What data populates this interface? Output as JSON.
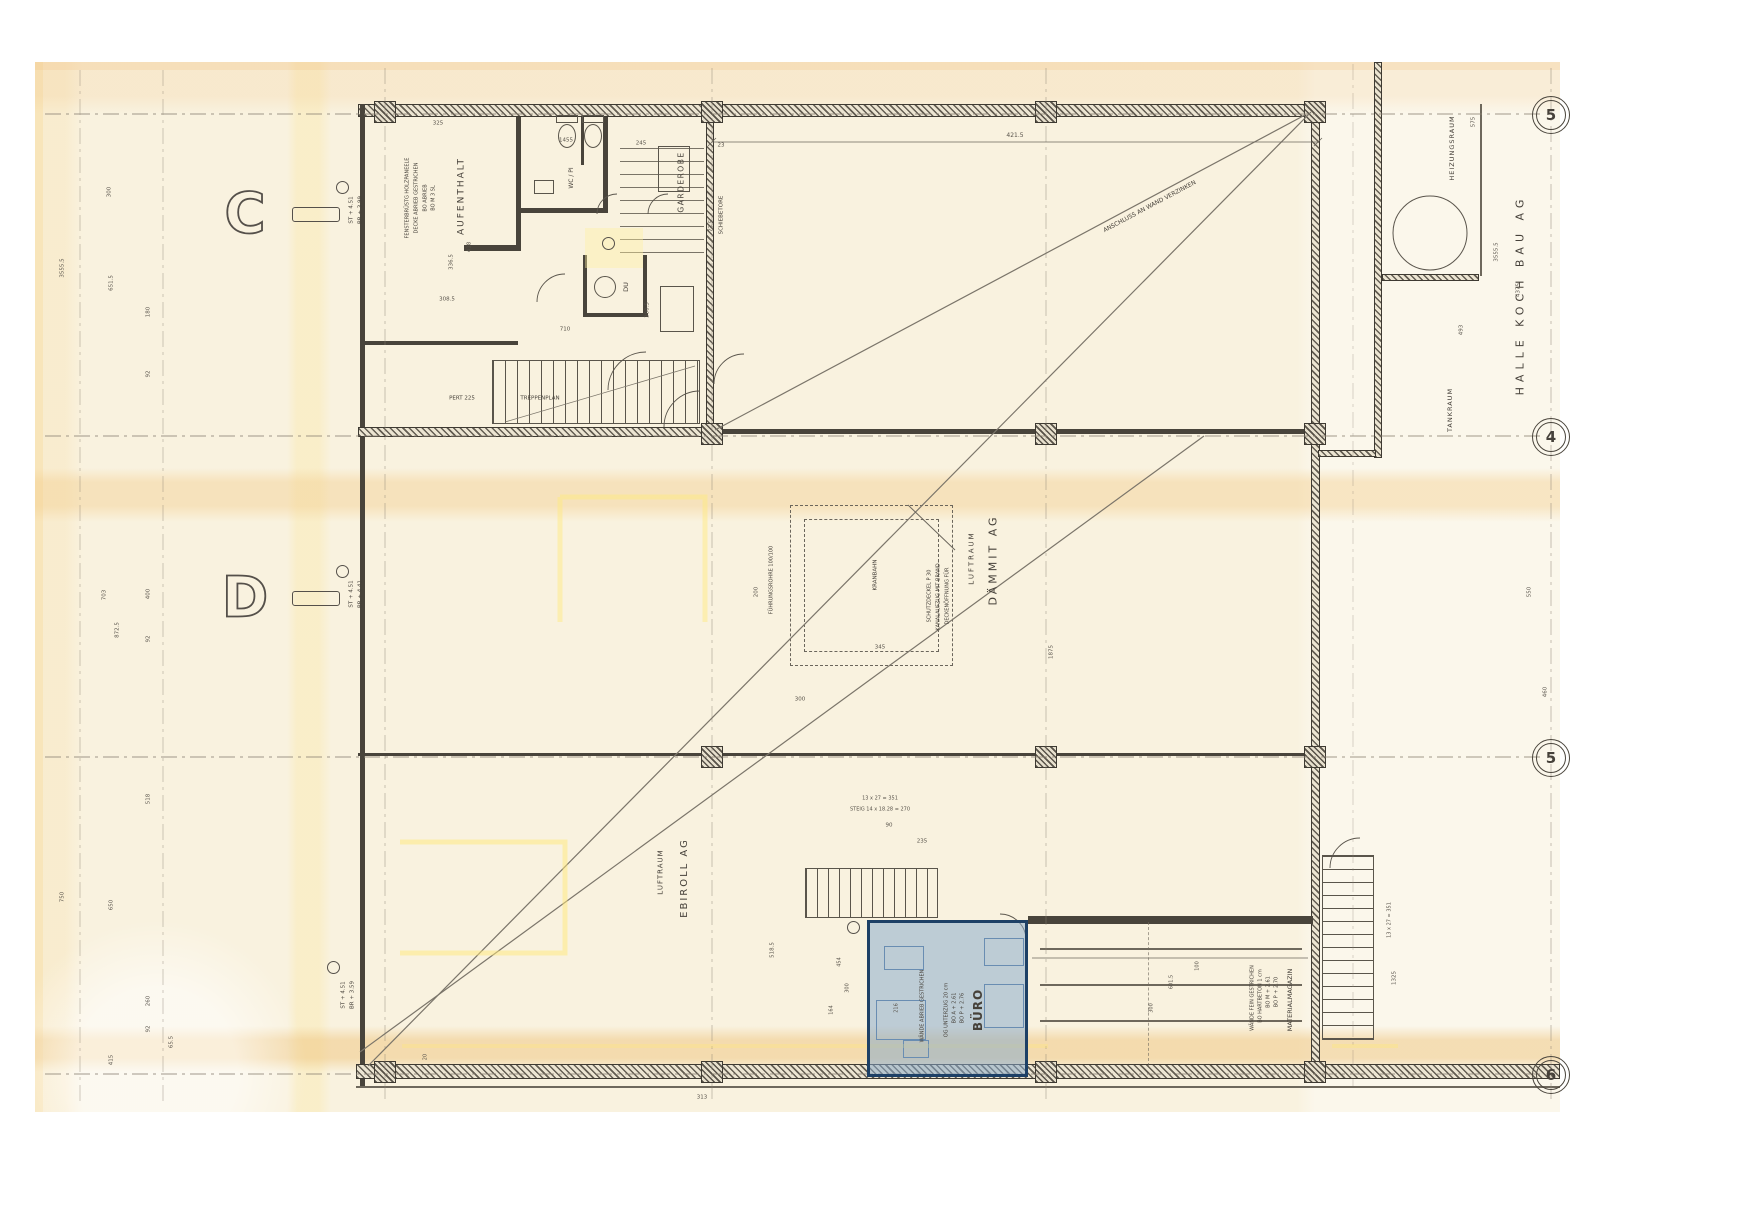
{
  "plan": {
    "colors": {
      "paper": "#f9f2df",
      "ink": "#46413a",
      "dim_text": "#57524a",
      "highlight_fill": "#87a9cc",
      "highlight_border": "#1d4066",
      "highlighter_yellow": "#ffe87a"
    },
    "highlight": {
      "room": "BÜRO"
    },
    "axis_markers": [
      {
        "label": "5",
        "x": 1550,
        "y": 114
      },
      {
        "label": "4",
        "x": 1550,
        "y": 436
      },
      {
        "label": "5",
        "x": 1550,
        "y": 757
      },
      {
        "label": "6",
        "x": 1550,
        "y": 1074
      }
    ],
    "section_letters": [
      {
        "letter": "C",
        "x": 245,
        "y": 214,
        "bar_x": 292,
        "bar_y": 207
      },
      {
        "letter": "D",
        "x": 245,
        "y": 598,
        "bar_x": 292,
        "bar_y": 591
      }
    ],
    "rings": [
      {
        "x": 341,
        "y": 186
      },
      {
        "x": 341,
        "y": 570
      },
      {
        "x": 332,
        "y": 966
      },
      {
        "x": 607,
        "y": 242
      },
      {
        "x": 852,
        "y": 926
      }
    ],
    "labels": [
      {
        "t": "AUFENTHALT",
        "x": 462,
        "y": 196,
        "r": -90,
        "s": 9,
        "sp": 2
      },
      {
        "t": "BO M 3 SL",
        "x": 434,
        "y": 198,
        "r": -90,
        "s": 5
      },
      {
        "t": "BO ABRIEB",
        "x": 426,
        "y": 198,
        "r": -90,
        "s": 5
      },
      {
        "t": "DECKE ABRIEB GESTRICHEN",
        "x": 417,
        "y": 198,
        "r": -90,
        "s": 5
      },
      {
        "t": "FENSTERBRÜSTG HOLZPANEELE",
        "x": 408,
        "y": 198,
        "r": -90,
        "s": 5
      },
      {
        "t": "GARDEROBE",
        "x": 681,
        "y": 182,
        "r": -90,
        "s": 7.5,
        "sp": 1.5
      },
      {
        "t": "WC / PI",
        "x": 572,
        "y": 178,
        "r": -90,
        "s": 6
      },
      {
        "t": "DU",
        "x": 626,
        "y": 287,
        "r": -90,
        "s": 6.5
      },
      {
        "t": "SCHIEBETORE",
        "x": 722,
        "y": 215,
        "r": -90,
        "s": 5.5
      },
      {
        "t": "TREPPENPLAN",
        "x": 540,
        "y": 399,
        "s": 5.5
      },
      {
        "t": "PERT 225",
        "x": 462,
        "y": 399,
        "s": 5.5
      },
      {
        "t": "DÄMMIT AG",
        "x": 993,
        "y": 560,
        "r": -90,
        "s": 11,
        "sp": 3
      },
      {
        "t": "LUFTRAUM",
        "x": 972,
        "y": 558,
        "r": -90,
        "s": 7,
        "sp": 2
      },
      {
        "t": "KRANBAHN",
        "x": 876,
        "y": 575,
        "r": -90,
        "s": 5.5
      },
      {
        "t": "DECKENÖFFNUNG FÜR",
        "x": 948,
        "y": 596,
        "r": -90,
        "s": 5
      },
      {
        "t": "KANALAUFZUG MIT BRAND-",
        "x": 939,
        "y": 596,
        "r": -90,
        "s": 5
      },
      {
        "t": "SCHUTZDECKEL P 30",
        "x": 930,
        "y": 596,
        "r": -90,
        "s": 5
      },
      {
        "t": "FÜHRUNGSROHRE 100/100",
        "x": 772,
        "y": 580,
        "r": -90,
        "s": 5
      },
      {
        "t": "EBIROLL AG",
        "x": 685,
        "y": 878,
        "r": -90,
        "s": 10,
        "sp": 2
      },
      {
        "t": "LUFTRAUM",
        "x": 661,
        "y": 872,
        "r": -90,
        "s": 7,
        "sp": 1
      },
      {
        "t": "HALLE KOCH BAU AG",
        "x": 1520,
        "y": 295,
        "r": -90,
        "s": 11,
        "sp": 5
      },
      {
        "t": "HEIZUNGSRAUM",
        "x": 1452,
        "y": 148,
        "r": -90,
        "s": 6.5,
        "sp": 1
      },
      {
        "t": "TANKRAUM",
        "x": 1450,
        "y": 410,
        "r": -90,
        "s": 6.5,
        "sp": 1
      },
      {
        "t": "MATERIALMAGAZIN",
        "x": 1290,
        "y": 1000,
        "r": -90,
        "s": 6.5
      },
      {
        "t": "BO P + 2.70",
        "x": 1277,
        "y": 992,
        "r": -90,
        "s": 5
      },
      {
        "t": "BO M + 2.61",
        "x": 1269,
        "y": 992,
        "r": -90,
        "s": 5
      },
      {
        "t": "BO HARTBETON 1 cm",
        "x": 1261,
        "y": 996,
        "r": -90,
        "s": 5
      },
      {
        "t": "WÄNDE FEIN GESTRICHEN",
        "x": 1253,
        "y": 998,
        "r": -90,
        "s": 5
      },
      {
        "t": "BÜRO",
        "x": 978,
        "y": 1010,
        "r": -90,
        "s": 12,
        "w": 700,
        "sp": 1
      },
      {
        "t": "BO P + 2.76",
        "x": 963,
        "y": 1008,
        "r": -90,
        "s": 5
      },
      {
        "t": "BO A + 2.61",
        "x": 955,
        "y": 1008,
        "r": -90,
        "s": 5
      },
      {
        "t": "OG UNTERZUG 20 cm",
        "x": 947,
        "y": 1010,
        "r": -90,
        "s": 5
      },
      {
        "t": "WÄNDE ABRIEB GESTRICHEN",
        "x": 923,
        "y": 1006,
        "r": -90,
        "s": 5
      },
      {
        "t": "ANSCHLUSS AN WAND VERZINKEN",
        "x": 1150,
        "y": 207,
        "r": -28,
        "s": 6
      },
      {
        "t": "ST + 4.51",
        "x": 352,
        "y": 210,
        "r": -90,
        "s": 5.5
      },
      {
        "t": "BR + 3.99",
        "x": 361,
        "y": 210,
        "r": -90,
        "s": 5.5
      },
      {
        "t": "ST + 4.51",
        "x": 352,
        "y": 594,
        "r": -90,
        "s": 5.5
      },
      {
        "t": "BR + 4.41",
        "x": 361,
        "y": 594,
        "r": -90,
        "s": 5.5
      },
      {
        "t": "ST + 4.51",
        "x": 344,
        "y": 995,
        "r": -90,
        "s": 5.5
      },
      {
        "t": "BR + 3.59",
        "x": 353,
        "y": 995,
        "r": -90,
        "s": 5.5
      },
      {
        "t": "421.5",
        "x": 1015,
        "y": 136,
        "s": 6,
        "c": "dim"
      },
      {
        "t": "325",
        "x": 438,
        "y": 124,
        "s": 5.5,
        "c": "dim"
      },
      {
        "t": "1455",
        "x": 566,
        "y": 141,
        "s": 5.5,
        "c": "dim"
      },
      {
        "t": "245",
        "x": 641,
        "y": 144,
        "s": 5.5,
        "c": "dim"
      },
      {
        "t": "23",
        "x": 721,
        "y": 146,
        "s": 5.5,
        "c": "dim"
      },
      {
        "t": "73.5",
        "x": 712,
        "y": 226,
        "r": -90,
        "s": 5.5,
        "c": "dim"
      },
      {
        "t": "418",
        "x": 470,
        "y": 247,
        "r": -90,
        "s": 5.5,
        "c": "dim"
      },
      {
        "t": "336.5",
        "x": 452,
        "y": 262,
        "r": -90,
        "s": 5.5,
        "c": "dim"
      },
      {
        "t": "308.5",
        "x": 447,
        "y": 300,
        "s": 5.5,
        "c": "dim"
      },
      {
        "t": "710",
        "x": 565,
        "y": 330,
        "s": 5.5,
        "c": "dim"
      },
      {
        "t": "300.5",
        "x": 648,
        "y": 310,
        "r": -90,
        "s": 5.5,
        "c": "dim"
      },
      {
        "t": "1875",
        "x": 1052,
        "y": 652,
        "r": -90,
        "s": 5.5,
        "c": "dim"
      },
      {
        "t": "200",
        "x": 757,
        "y": 592,
        "r": -90,
        "s": 5.5,
        "c": "dim"
      },
      {
        "t": "300",
        "x": 800,
        "y": 700,
        "s": 5.5,
        "c": "dim"
      },
      {
        "t": "345",
        "x": 880,
        "y": 648,
        "s": 5.5,
        "c": "dim"
      },
      {
        "t": "90",
        "x": 889,
        "y": 826,
        "s": 5.5,
        "c": "dim"
      },
      {
        "t": "235",
        "x": 922,
        "y": 842,
        "s": 5.5,
        "c": "dim"
      },
      {
        "t": "13 x 27 = 351",
        "x": 880,
        "y": 799,
        "s": 5,
        "c": "dim"
      },
      {
        "t": "STEIG 14 x 18.28 = 270",
        "x": 880,
        "y": 810,
        "s": 5,
        "c": "dim"
      },
      {
        "t": "518.5",
        "x": 773,
        "y": 950,
        "r": -90,
        "s": 5.5,
        "c": "dim"
      },
      {
        "t": "454",
        "x": 840,
        "y": 962,
        "r": -90,
        "s": 5,
        "c": "dim"
      },
      {
        "t": "300",
        "x": 848,
        "y": 988,
        "r": -90,
        "s": 5,
        "c": "dim"
      },
      {
        "t": "164",
        "x": 832,
        "y": 1010,
        "r": -90,
        "s": 5,
        "c": "dim"
      },
      {
        "t": "216",
        "x": 897,
        "y": 1008,
        "r": -90,
        "s": 5,
        "c": "dim"
      },
      {
        "t": "20",
        "x": 426,
        "y": 1057,
        "r": -90,
        "s": 5,
        "c": "dim"
      },
      {
        "t": "313",
        "x": 702,
        "y": 1098,
        "s": 5.5,
        "c": "dim"
      },
      {
        "t": "100",
        "x": 1198,
        "y": 966,
        "r": -90,
        "s": 5,
        "c": "dim"
      },
      {
        "t": "601.5",
        "x": 1172,
        "y": 982,
        "r": -90,
        "s": 5,
        "c": "dim"
      },
      {
        "t": "300",
        "x": 1152,
        "y": 1008,
        "r": -90,
        "s": 5,
        "c": "dim"
      },
      {
        "t": "1325",
        "x": 1395,
        "y": 978,
        "r": -90,
        "s": 5.5,
        "c": "dim"
      },
      {
        "t": "493",
        "x": 1462,
        "y": 330,
        "r": -90,
        "s": 5.5,
        "c": "dim"
      },
      {
        "t": "575",
        "x": 1474,
        "y": 122,
        "r": -90,
        "s": 5.5,
        "c": "dim"
      },
      {
        "t": "3555.5",
        "x": 1497,
        "y": 252,
        "r": -90,
        "s": 5.5,
        "c": "dim"
      },
      {
        "t": "4375",
        "x": 1519,
        "y": 290,
        "r": -90,
        "s": 5.5,
        "c": "dim"
      },
      {
        "t": "550",
        "x": 1530,
        "y": 592,
        "r": -90,
        "s": 5.5,
        "c": "dim"
      },
      {
        "t": "460",
        "x": 1546,
        "y": 692,
        "r": -90,
        "s": 5.5,
        "c": "dim"
      },
      {
        "t": "13 x 27 = 351",
        "x": 1390,
        "y": 920,
        "r": -90,
        "s": 5,
        "c": "dim"
      },
      {
        "t": "300",
        "x": 110,
        "y": 192,
        "r": -90,
        "s": 5.5,
        "c": "dim"
      },
      {
        "t": "3555.5",
        "x": 63,
        "y": 268,
        "r": -90,
        "s": 5.5,
        "c": "dim"
      },
      {
        "t": "651.5",
        "x": 112,
        "y": 283,
        "r": -90,
        "s": 5.5,
        "c": "dim"
      },
      {
        "t": "180",
        "x": 149,
        "y": 312,
        "r": -90,
        "s": 5.5,
        "c": "dim"
      },
      {
        "t": "92",
        "x": 149,
        "y": 374,
        "r": -90,
        "s": 5.5,
        "c": "dim"
      },
      {
        "t": "703",
        "x": 105,
        "y": 595,
        "r": -90,
        "s": 5.5,
        "c": "dim"
      },
      {
        "t": "872.5",
        "x": 118,
        "y": 630,
        "r": -90,
        "s": 5.5,
        "c": "dim"
      },
      {
        "t": "400",
        "x": 149,
        "y": 594,
        "r": -90,
        "s": 5.5,
        "c": "dim"
      },
      {
        "t": "92",
        "x": 149,
        "y": 639,
        "r": -90,
        "s": 5.5,
        "c": "dim"
      },
      {
        "t": "518",
        "x": 149,
        "y": 799,
        "r": -90,
        "s": 5.5,
        "c": "dim"
      },
      {
        "t": "650",
        "x": 112,
        "y": 905,
        "r": -90,
        "s": 5.5,
        "c": "dim"
      },
      {
        "t": "750",
        "x": 63,
        "y": 897,
        "r": -90,
        "s": 5.5,
        "c": "dim"
      },
      {
        "t": "260",
        "x": 149,
        "y": 1001,
        "r": -90,
        "s": 5.5,
        "c": "dim"
      },
      {
        "t": "92",
        "x": 149,
        "y": 1029,
        "r": -90,
        "s": 5.5,
        "c": "dim"
      },
      {
        "t": "415",
        "x": 112,
        "y": 1060,
        "r": -90,
        "s": 5.5,
        "c": "dim"
      },
      {
        "t": "65.5",
        "x": 172,
        "y": 1042,
        "r": -90,
        "s": 5.5,
        "c": "dim"
      }
    ]
  }
}
